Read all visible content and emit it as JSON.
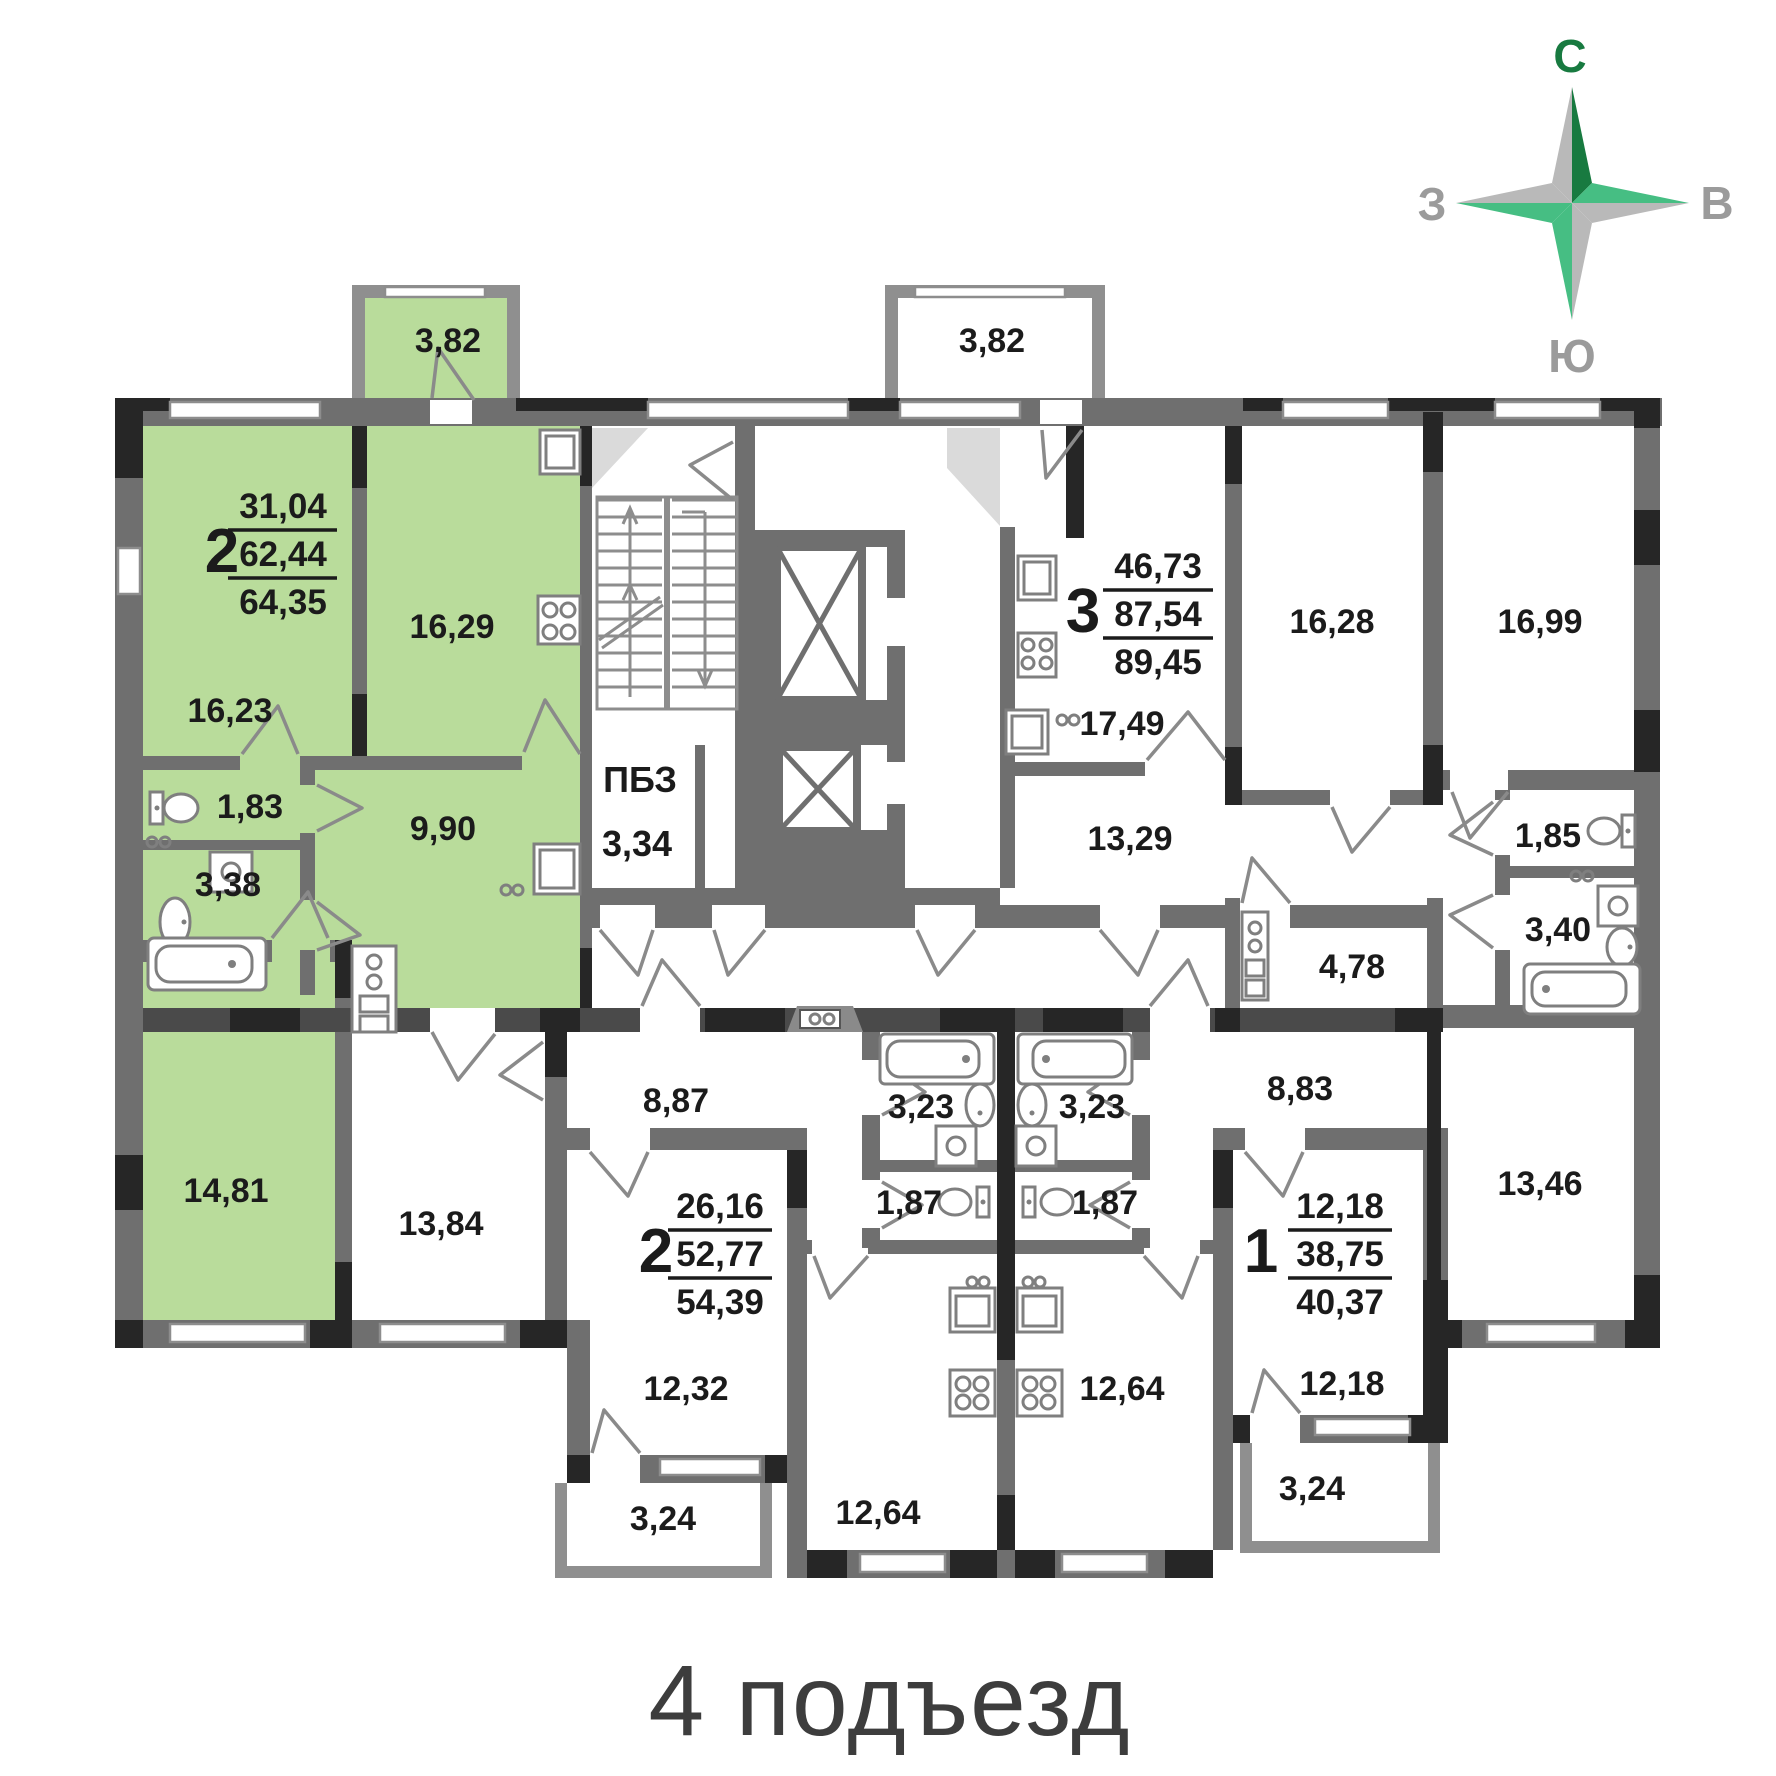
{
  "page": {
    "title": "4 подъезд"
  },
  "compass": {
    "north": "С",
    "east": "В",
    "south": "Ю",
    "west": "З"
  },
  "colors": {
    "highlight": "#b9dc9b",
    "compass_dark": "#187a40",
    "compass_green": "#46be83",
    "compass_gray": "#b9b9b9"
  },
  "common": {
    "pbz_label": "ПБЗ",
    "pbz_area": "3,34"
  },
  "apartments": [
    {
      "id": "apt-2k-left",
      "label": "2",
      "highlighted": true,
      "living_area": "31,04",
      "apartment_area": "62,44",
      "total_area": "64,35",
      "rooms": {
        "bedroom": "16,23",
        "kitchen": "16,29",
        "balcony": "3,82",
        "wc": "1,83",
        "bathroom": "3,38",
        "hall": "9,90",
        "living_room": "14,81"
      }
    },
    {
      "id": "apt-3k",
      "label": "3",
      "highlighted": false,
      "living_area": "46,73",
      "apartment_area": "87,54",
      "total_area": "89,45",
      "rooms": {
        "balcony": "3,82",
        "kitchen": "17,49",
        "bedroom1": "16,28",
        "bedroom2": "16,99",
        "hall": "13,29",
        "corridor": "4,78",
        "wc": "1,85",
        "bathroom": "3,40",
        "bedroom3": "13,46"
      }
    },
    {
      "id": "apt-2k-bottom",
      "label": "2",
      "highlighted": false,
      "living_area": "26,16",
      "apartment_area": "52,77",
      "total_area": "54,39",
      "rooms": {
        "hall": "8,87",
        "bedroom1": "13,84",
        "bedroom2": "12,32",
        "bathroom": "3,23",
        "wc": "1,87",
        "kitchen": "12,64",
        "balcony": "3,24"
      }
    },
    {
      "id": "apt-1k",
      "label": "1",
      "highlighted": false,
      "living_area": "12,18",
      "apartment_area": "38,75",
      "total_area": "40,37",
      "rooms": {
        "hall": "8,83",
        "bedroom": "12,18",
        "bathroom": "3,23",
        "wc": "1,87",
        "kitchen": "12,64",
        "balcony": "3,24"
      }
    }
  ]
}
